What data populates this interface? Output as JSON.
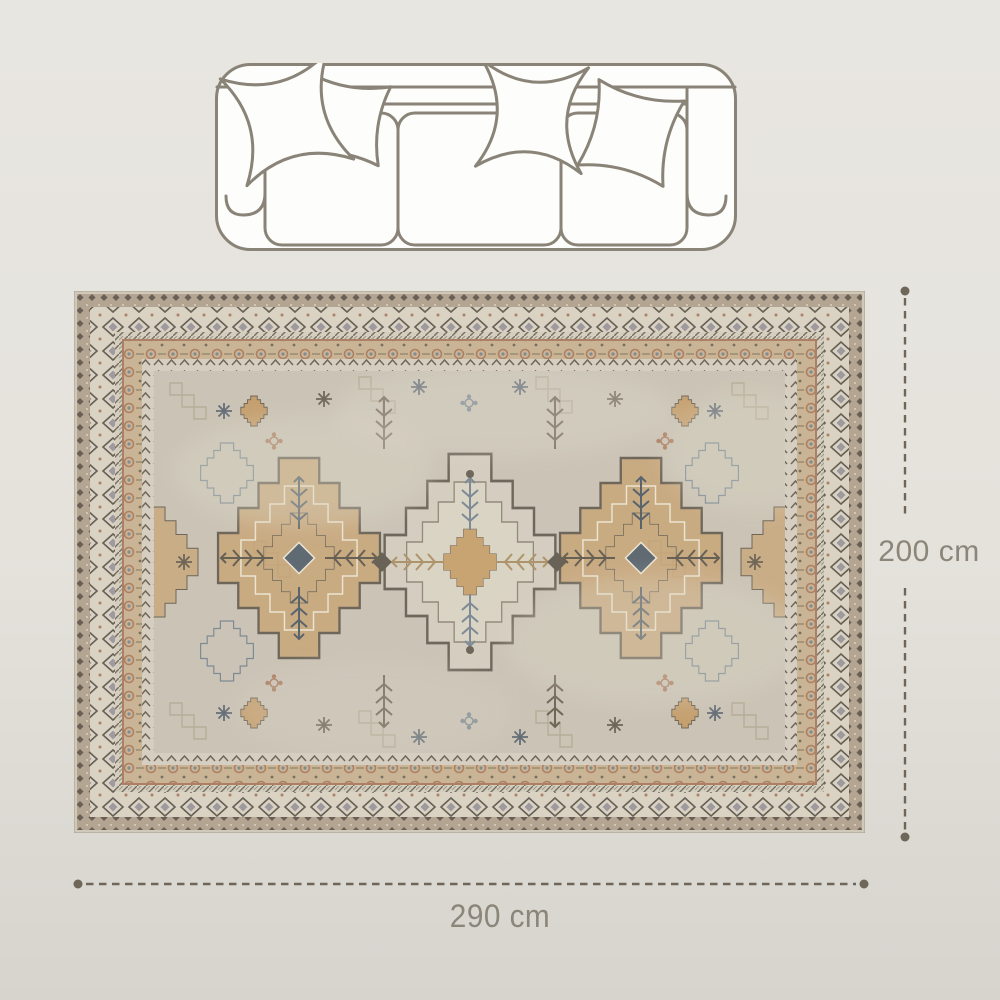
{
  "page": {
    "background_color": "#e5e2dc",
    "content_type": "rug-size-diagram"
  },
  "sofa": {
    "name": "three-seat-sofa-top-view",
    "outline_color": "#8a8377",
    "fill_color": "#fdfdfb",
    "seat_count": 3,
    "pillow_count": 4
  },
  "rug": {
    "name": "vintage-oriental-area-rug",
    "medallion_count": 3,
    "colors": {
      "field": "#c9c2b4",
      "edge": "#cfc7b8",
      "border_dark_band": "#b0a08c",
      "border_cream_band": "#d9d2c3",
      "border_tan_band": "#c7b190",
      "border_inner_band": "#d5cebf",
      "motif_dark": "#5f574b",
      "medallion_tan": "#c69e6a",
      "accent_blue": "#76848f",
      "accent_rust": "#a9775b"
    }
  },
  "dimensions": {
    "height_label": "200 cm",
    "width_label": "290 cm",
    "line_color": "#6e6759",
    "label_color": "#8b857a"
  }
}
